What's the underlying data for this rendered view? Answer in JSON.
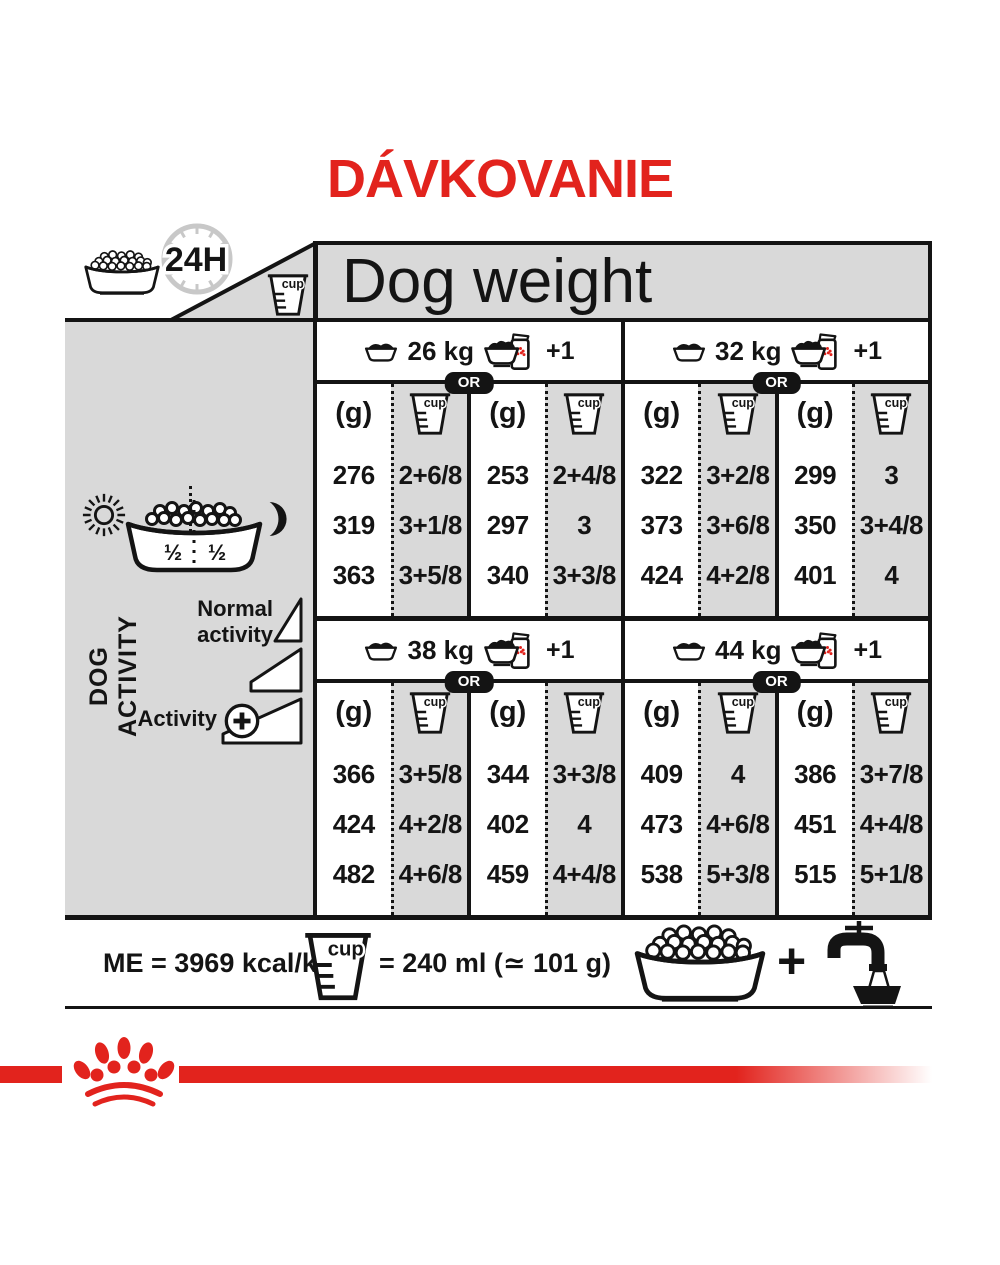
{
  "title": "DÁVKOVANIE",
  "header": {
    "dog_weight_label": "Dog weight",
    "clock_label": "24H"
  },
  "icons": {
    "cup_text": "cup",
    "names": [
      "kibble-bowl-icon",
      "clock-24h-icon",
      "measuring-cup-icon",
      "dry-bowl-icon",
      "bowl-plus-pouch-icon",
      "sun-icon",
      "moon-icon",
      "half-half-bowl-icon",
      "activity-wedge-icon",
      "plus-circle-icon",
      "water-tap-icon",
      "paw-crown-logo"
    ]
  },
  "sidebar": {
    "dog_activity_label": "DOG ACTIVITY",
    "half_left": "½",
    "half_right": "½",
    "normal_activity_label": "Normal activity",
    "activity_label": "Activity",
    "plus_symbol": "+"
  },
  "table": {
    "or_label": "OR",
    "plus_one_label": "+1",
    "grams_header": "(g)",
    "sections": [
      {
        "weight": "26 kg",
        "dry_only": {
          "grams": [
            "276",
            "319",
            "363"
          ],
          "cups": [
            "2+6/8",
            "3+1/8",
            "3+5/8"
          ]
        },
        "dry_plus_wet": {
          "grams": [
            "253",
            "297",
            "340"
          ],
          "cups": [
            "2+4/8",
            "3",
            "3+3/8"
          ]
        }
      },
      {
        "weight": "32 kg",
        "dry_only": {
          "grams": [
            "322",
            "373",
            "424"
          ],
          "cups": [
            "3+2/8",
            "3+6/8",
            "4+2/8"
          ]
        },
        "dry_plus_wet": {
          "grams": [
            "299",
            "350",
            "401"
          ],
          "cups": [
            "3",
            "3+4/8",
            "4"
          ]
        }
      },
      {
        "weight": "38 kg",
        "dry_only": {
          "grams": [
            "366",
            "424",
            "482"
          ],
          "cups": [
            "3+5/8",
            "4+2/8",
            "4+6/8"
          ]
        },
        "dry_plus_wet": {
          "grams": [
            "344",
            "402",
            "459"
          ],
          "cups": [
            "3+3/8",
            "4",
            "4+4/8"
          ]
        }
      },
      {
        "weight": "44 kg",
        "dry_only": {
          "grams": [
            "409",
            "473",
            "538"
          ],
          "cups": [
            "4",
            "4+6/8",
            "5+3/8"
          ]
        },
        "dry_plus_wet": {
          "grams": [
            "386",
            "451",
            "515"
          ],
          "cups": [
            "3+7/8",
            "4+4/8",
            "5+1/8"
          ]
        }
      }
    ]
  },
  "footer": {
    "me_label": "ME = 3969 kcal/kg",
    "cup_equals_label": "= 240 ml (≃ 101 g)",
    "plus_symbol": "+"
  },
  "colors": {
    "accent_red": "#e2231d",
    "panel_gray": "#d9d9d9",
    "ink_black": "#141414",
    "clock_gray": "#c8c8c8"
  }
}
